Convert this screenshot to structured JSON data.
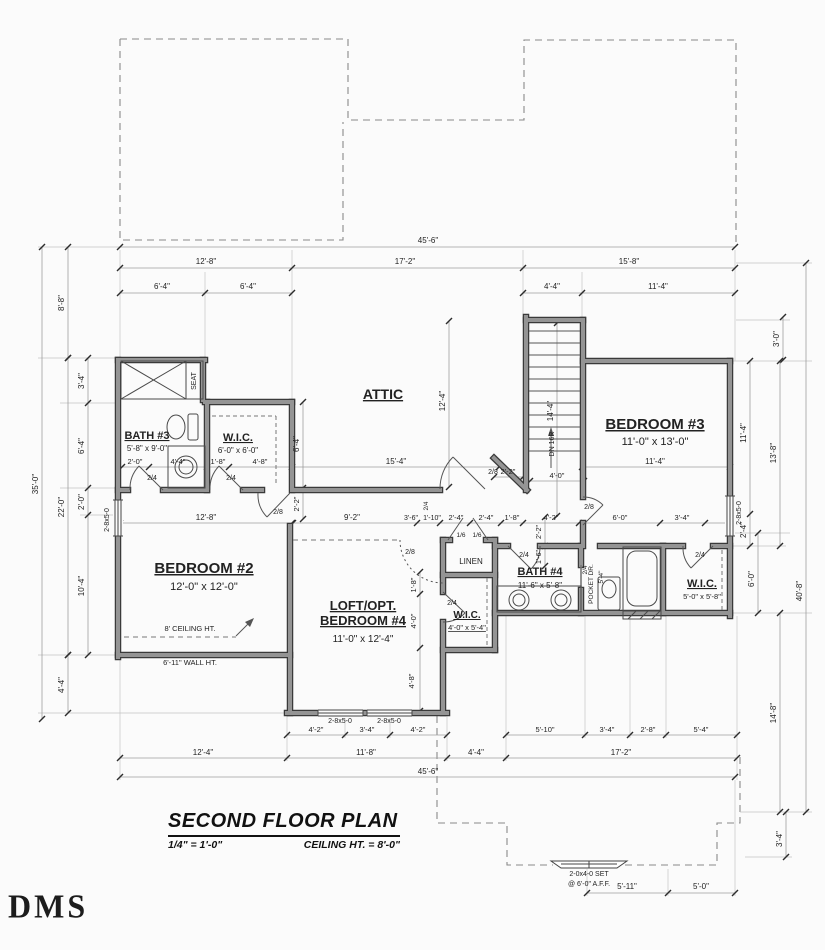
{
  "title_block": {
    "title": "SECOND FLOOR PLAN",
    "scale": "1/4\" = 1'-0\"",
    "ceiling_note": "CEILING HT. = 8'-0\""
  },
  "logo_text": "DMS",
  "labels": [
    {
      "t": "ATTIC",
      "x": 383,
      "y": 399,
      "s": 14,
      "b": 1,
      "u": 1,
      "n": "room-label-attic"
    },
    {
      "t": "BATH #3",
      "x": 147,
      "y": 439,
      "s": 11,
      "b": 1,
      "u": 1,
      "n": "room-label-bath3"
    },
    {
      "t": "5'-8\" x 9'-0\"",
      "x": 147,
      "y": 451,
      "s": 8,
      "n": "room-size-bath3"
    },
    {
      "t": "W.I.C.",
      "x": 238,
      "y": 441,
      "s": 11,
      "b": 1,
      "u": 1,
      "n": "room-label-wic1"
    },
    {
      "t": "6'-0\" x 6'-0\"",
      "x": 238,
      "y": 453,
      "s": 8,
      "n": "room-size-wic1"
    },
    {
      "t": "BEDROOM #2",
      "x": 204,
      "y": 573,
      "s": 15,
      "b": 1,
      "u": 1,
      "n": "room-label-bedroom2"
    },
    {
      "t": "12'-0\" x 12'-0\"",
      "x": 204,
      "y": 590,
      "s": 11,
      "n": "room-size-bedroom2"
    },
    {
      "t": "BEDROOM #3",
      "x": 655,
      "y": 429,
      "s": 15,
      "b": 1,
      "u": 1,
      "n": "room-label-bedroom3"
    },
    {
      "t": "11'-0\" x 13'-0\"",
      "x": 655,
      "y": 445,
      "s": 11,
      "n": "room-size-bedroom3"
    },
    {
      "t": "LOFT/OPT.",
      "x": 363,
      "y": 610,
      "s": 13,
      "b": 1,
      "u": 1,
      "n": "room-label-loft-line1"
    },
    {
      "t": "BEDROOM #4",
      "x": 363,
      "y": 625,
      "s": 13,
      "b": 1,
      "u": 1,
      "n": "room-label-loft-line2"
    },
    {
      "t": "11'-0\" x 12'-4\"",
      "x": 363,
      "y": 642,
      "s": 10,
      "n": "room-size-loft"
    },
    {
      "t": "BATH #4",
      "x": 540,
      "y": 575,
      "s": 11,
      "b": 1,
      "u": 1,
      "n": "room-label-bath4"
    },
    {
      "t": "11'-6\" x 5'-8\"",
      "x": 540,
      "y": 588,
      "s": 8,
      "n": "room-size-bath4"
    },
    {
      "t": "W.I.C.",
      "x": 702,
      "y": 587,
      "s": 11,
      "b": 1,
      "u": 1,
      "n": "room-label-wic2"
    },
    {
      "t": "5'-0\" x 5'-8\"",
      "x": 702,
      "y": 599,
      "s": 7.5,
      "n": "room-size-wic2"
    },
    {
      "t": "W.I.C.",
      "x": 467,
      "y": 618,
      "s": 10,
      "b": 1,
      "u": 1,
      "n": "room-label-wic3"
    },
    {
      "t": "4'-0\" x 5'-4\"",
      "x": 467,
      "y": 630,
      "s": 7.5,
      "u": 1,
      "n": "room-size-wic3"
    },
    {
      "t": "LINEN",
      "x": 471,
      "y": 564,
      "s": 8,
      "n": "room-label-linen"
    },
    {
      "t": "SEAT",
      "x": 196,
      "y": 381,
      "s": 7,
      "r": -90,
      "n": "note-seat"
    },
    {
      "t": "8' CEILING HT.",
      "x": 190,
      "y": 631,
      "s": 7.5,
      "n": "note-ceiling-ht"
    },
    {
      "t": "6'-11\" WALL HT.",
      "x": 190,
      "y": 665,
      "s": 7.5,
      "n": "note-wall-ht"
    },
    {
      "t": "DN 16R",
      "x": 554,
      "y": 444,
      "s": 7,
      "r": -90,
      "n": "note-stair-dn"
    },
    {
      "t": "POCKET DR.",
      "x": 593,
      "y": 584,
      "s": 6.5,
      "r": -90,
      "n": "note-pocket-door"
    },
    {
      "t": "5'-4\"",
      "x": 603,
      "y": 577,
      "s": 6.5,
      "r": -90,
      "n": "note-pocket-size"
    },
    {
      "t": "2-0x4-0 SET",
      "x": 589,
      "y": 876,
      "s": 7,
      "n": "window-label-set"
    },
    {
      "t": "@ 6'-0\" A.F.F.",
      "x": 589,
      "y": 886,
      "s": 7,
      "n": "window-label-aff"
    },
    {
      "t": "2-8x5-0",
      "x": 109,
      "y": 520,
      "s": 7,
      "r": -90,
      "n": "window-label"
    },
    {
      "t": "2-8x5-0",
      "x": 741,
      "y": 513,
      "s": 7,
      "r": -90,
      "n": "window-label"
    },
    {
      "t": "2-8x5-0",
      "x": 340,
      "y": 723,
      "s": 7,
      "n": "window-label"
    },
    {
      "t": "2-8x5-0",
      "x": 389,
      "y": 723,
      "s": 7,
      "n": "window-label"
    },
    {
      "t": "2/4",
      "x": 152,
      "y": 480,
      "s": 7,
      "n": "door-label"
    },
    {
      "t": "2/4",
      "x": 231,
      "y": 480,
      "s": 7,
      "n": "door-label"
    },
    {
      "t": "2/8",
      "x": 278,
      "y": 514,
      "s": 7,
      "n": "door-label"
    },
    {
      "t": "2/8",
      "x": 493,
      "y": 474,
      "s": 7,
      "n": "door-label"
    },
    {
      "t": "2/8",
      "x": 589,
      "y": 509,
      "s": 7,
      "n": "door-label"
    },
    {
      "t": "2/8",
      "x": 410,
      "y": 554,
      "s": 7,
      "n": "door-label"
    },
    {
      "t": "1/6",
      "x": 461,
      "y": 537,
      "s": 6.5,
      "n": "door-label"
    },
    {
      "t": "1/6",
      "x": 477,
      "y": 537,
      "s": 6.5,
      "n": "door-label"
    },
    {
      "t": "2/4",
      "x": 524,
      "y": 557,
      "s": 7,
      "n": "door-label"
    },
    {
      "t": "2/4",
      "x": 700,
      "y": 557,
      "s": 7,
      "n": "door-label"
    },
    {
      "t": "2/4",
      "x": 587,
      "y": 570,
      "s": 6.5,
      "r": -90,
      "n": "door-label"
    },
    {
      "t": "2/4",
      "x": 452,
      "y": 605,
      "s": 7,
      "n": "door-label"
    },
    {
      "t": "2/4",
      "x": 428,
      "y": 506,
      "s": 6.5,
      "r": -90,
      "n": "door-label"
    },
    {
      "t": "45'-6\"",
      "x": 428,
      "y": 243,
      "s": 8,
      "n": "dim"
    },
    {
      "t": "12'-8\"",
      "x": 206,
      "y": 264,
      "s": 8,
      "n": "dim"
    },
    {
      "t": "17'-2\"",
      "x": 405,
      "y": 264,
      "s": 8,
      "n": "dim"
    },
    {
      "t": "15'-8\"",
      "x": 629,
      "y": 264,
      "s": 8,
      "n": "dim"
    },
    {
      "t": "6'-4\"",
      "x": 162,
      "y": 289,
      "s": 8,
      "n": "dim"
    },
    {
      "t": "6'-4\"",
      "x": 248,
      "y": 289,
      "s": 8,
      "n": "dim"
    },
    {
      "t": "4'-4\"",
      "x": 552,
      "y": 289,
      "s": 8,
      "n": "dim"
    },
    {
      "t": "11'-4\"",
      "x": 658,
      "y": 289,
      "s": 8,
      "n": "dim"
    },
    {
      "t": "8'-8\"",
      "x": 64,
      "y": 303,
      "s": 8,
      "r": -90,
      "n": "dim"
    },
    {
      "t": "35'-0\"",
      "x": 38,
      "y": 484,
      "s": 8,
      "r": -90,
      "n": "dim"
    },
    {
      "t": "22'-0\"",
      "x": 64,
      "y": 507,
      "s": 8,
      "r": -90,
      "n": "dim"
    },
    {
      "t": "3'-4\"",
      "x": 84,
      "y": 381,
      "s": 8,
      "r": -90,
      "n": "dim"
    },
    {
      "t": "6'-4\"",
      "x": 84,
      "y": 446,
      "s": 8,
      "r": -90,
      "n": "dim"
    },
    {
      "t": "2'-0\"",
      "x": 84,
      "y": 502,
      "s": 8,
      "r": -90,
      "n": "dim"
    },
    {
      "t": "10'-4\"",
      "x": 84,
      "y": 586,
      "s": 8,
      "r": -90,
      "n": "dim"
    },
    {
      "t": "4'-4\"",
      "x": 64,
      "y": 685,
      "s": 8,
      "r": -90,
      "n": "dim"
    },
    {
      "t": "2'-0\"",
      "x": 135,
      "y": 464,
      "s": 7.5,
      "n": "dim"
    },
    {
      "t": "4'-4\"",
      "x": 178,
      "y": 464,
      "s": 7.5,
      "n": "dim"
    },
    {
      "t": "1'-8\"",
      "x": 218,
      "y": 464,
      "s": 7.5,
      "n": "dim"
    },
    {
      "t": "4'-8\"",
      "x": 260,
      "y": 464,
      "s": 7.5,
      "n": "dim"
    },
    {
      "t": "15'-4\"",
      "x": 396,
      "y": 464,
      "s": 8,
      "n": "dim"
    },
    {
      "t": "2'-2\"",
      "x": 508,
      "y": 474,
      "s": 7.5,
      "n": "dim"
    },
    {
      "t": "4'-0\"",
      "x": 557,
      "y": 478,
      "s": 7.5,
      "n": "dim"
    },
    {
      "t": "12'-4\"",
      "x": 445,
      "y": 401,
      "s": 8,
      "r": -90,
      "n": "dim"
    },
    {
      "t": "6'-4\"",
      "x": 299,
      "y": 444,
      "s": 8,
      "r": -90,
      "n": "dim"
    },
    {
      "t": "2'-2\"",
      "x": 299,
      "y": 504,
      "s": 7.5,
      "r": -90,
      "n": "dim"
    },
    {
      "t": "14'-4\"",
      "x": 553,
      "y": 411,
      "s": 8,
      "r": -90,
      "n": "dim"
    },
    {
      "t": "12'-8\"",
      "x": 206,
      "y": 520,
      "s": 8,
      "n": "dim"
    },
    {
      "t": "9'-2\"",
      "x": 352,
      "y": 520,
      "s": 8,
      "n": "dim"
    },
    {
      "t": "3'-6\"",
      "x": 411,
      "y": 520,
      "s": 7,
      "n": "dim"
    },
    {
      "t": "1'-10\"",
      "x": 432,
      "y": 520,
      "s": 7,
      "n": "dim"
    },
    {
      "t": "2'-4\"",
      "x": 456,
      "y": 520,
      "s": 7.5,
      "n": "dim"
    },
    {
      "t": "2'-4\"",
      "x": 486,
      "y": 520,
      "s": 7.5,
      "n": "dim"
    },
    {
      "t": "1'-8\"",
      "x": 512,
      "y": 520,
      "s": 7.5,
      "n": "dim"
    },
    {
      "t": "4'-2\"",
      "x": 551,
      "y": 520,
      "s": 7.5,
      "n": "dim"
    },
    {
      "t": "6'-0\"",
      "x": 620,
      "y": 520,
      "s": 7.5,
      "n": "dim"
    },
    {
      "t": "3'-4\"",
      "x": 682,
      "y": 520,
      "s": 7.5,
      "n": "dim"
    },
    {
      "t": "11'-4\"",
      "x": 655,
      "y": 464,
      "s": 8,
      "n": "dim"
    },
    {
      "t": "1'-8\"",
      "x": 416,
      "y": 585,
      "s": 7.5,
      "r": -90,
      "n": "dim"
    },
    {
      "t": "4'-0\"",
      "x": 416,
      "y": 621,
      "s": 7.5,
      "r": -90,
      "n": "dim"
    },
    {
      "t": "4'-8\"",
      "x": 414,
      "y": 681,
      "s": 7.5,
      "r": -90,
      "n": "dim"
    },
    {
      "t": "2'-2\"",
      "x": 541,
      "y": 532,
      "s": 7,
      "r": -90,
      "n": "dim"
    },
    {
      "t": "1'-6\"",
      "x": 541,
      "y": 557,
      "s": 7,
      "r": -90,
      "n": "dim"
    },
    {
      "t": "3'-0\"",
      "x": 779,
      "y": 339,
      "s": 8,
      "r": -90,
      "n": "dim"
    },
    {
      "t": "11'-4\"",
      "x": 746,
      "y": 433,
      "s": 8,
      "r": -90,
      "n": "dim"
    },
    {
      "t": "13'-8\"",
      "x": 776,
      "y": 453,
      "s": 8,
      "r": -90,
      "n": "dim"
    },
    {
      "t": "2'-4\"",
      "x": 746,
      "y": 530,
      "s": 8,
      "r": -90,
      "n": "dim"
    },
    {
      "t": "6'-0\"",
      "x": 754,
      "y": 579,
      "s": 8,
      "r": -90,
      "n": "dim"
    },
    {
      "t": "40'-8\"",
      "x": 802,
      "y": 591,
      "s": 8,
      "r": -90,
      "n": "dim"
    },
    {
      "t": "14'-8\"",
      "x": 776,
      "y": 713,
      "s": 8,
      "r": -90,
      "n": "dim"
    },
    {
      "t": "3'-4\"",
      "x": 782,
      "y": 839,
      "s": 8,
      "r": -90,
      "n": "dim"
    },
    {
      "t": "4'-2\"",
      "x": 316,
      "y": 732,
      "s": 7.5,
      "n": "dim"
    },
    {
      "t": "3'-4\"",
      "x": 367,
      "y": 732,
      "s": 7.5,
      "n": "dim"
    },
    {
      "t": "4'-2\"",
      "x": 418,
      "y": 732,
      "s": 7.5,
      "n": "dim"
    },
    {
      "t": "5'-10\"",
      "x": 545,
      "y": 732,
      "s": 7.5,
      "n": "dim"
    },
    {
      "t": "3'-4\"",
      "x": 607,
      "y": 732,
      "s": 7.5,
      "n": "dim"
    },
    {
      "t": "2'-8\"",
      "x": 648,
      "y": 732,
      "s": 7.5,
      "n": "dim"
    },
    {
      "t": "5'-4\"",
      "x": 701,
      "y": 732,
      "s": 7.5,
      "n": "dim"
    },
    {
      "t": "12'-4\"",
      "x": 203,
      "y": 755,
      "s": 8,
      "n": "dim"
    },
    {
      "t": "11'-8\"",
      "x": 366,
      "y": 755,
      "s": 8,
      "n": "dim"
    },
    {
      "t": "4'-4\"",
      "x": 476,
      "y": 755,
      "s": 8,
      "n": "dim"
    },
    {
      "t": "17'-2\"",
      "x": 621,
      "y": 755,
      "s": 8,
      "n": "dim"
    },
    {
      "t": "45'-6\"",
      "x": 428,
      "y": 774,
      "s": 8,
      "n": "dim"
    },
    {
      "t": "5'-11\"",
      "x": 627,
      "y": 889,
      "s": 8,
      "n": "dim"
    },
    {
      "t": "5'-0\"",
      "x": 701,
      "y": 889,
      "s": 8,
      "n": "dim"
    }
  ]
}
